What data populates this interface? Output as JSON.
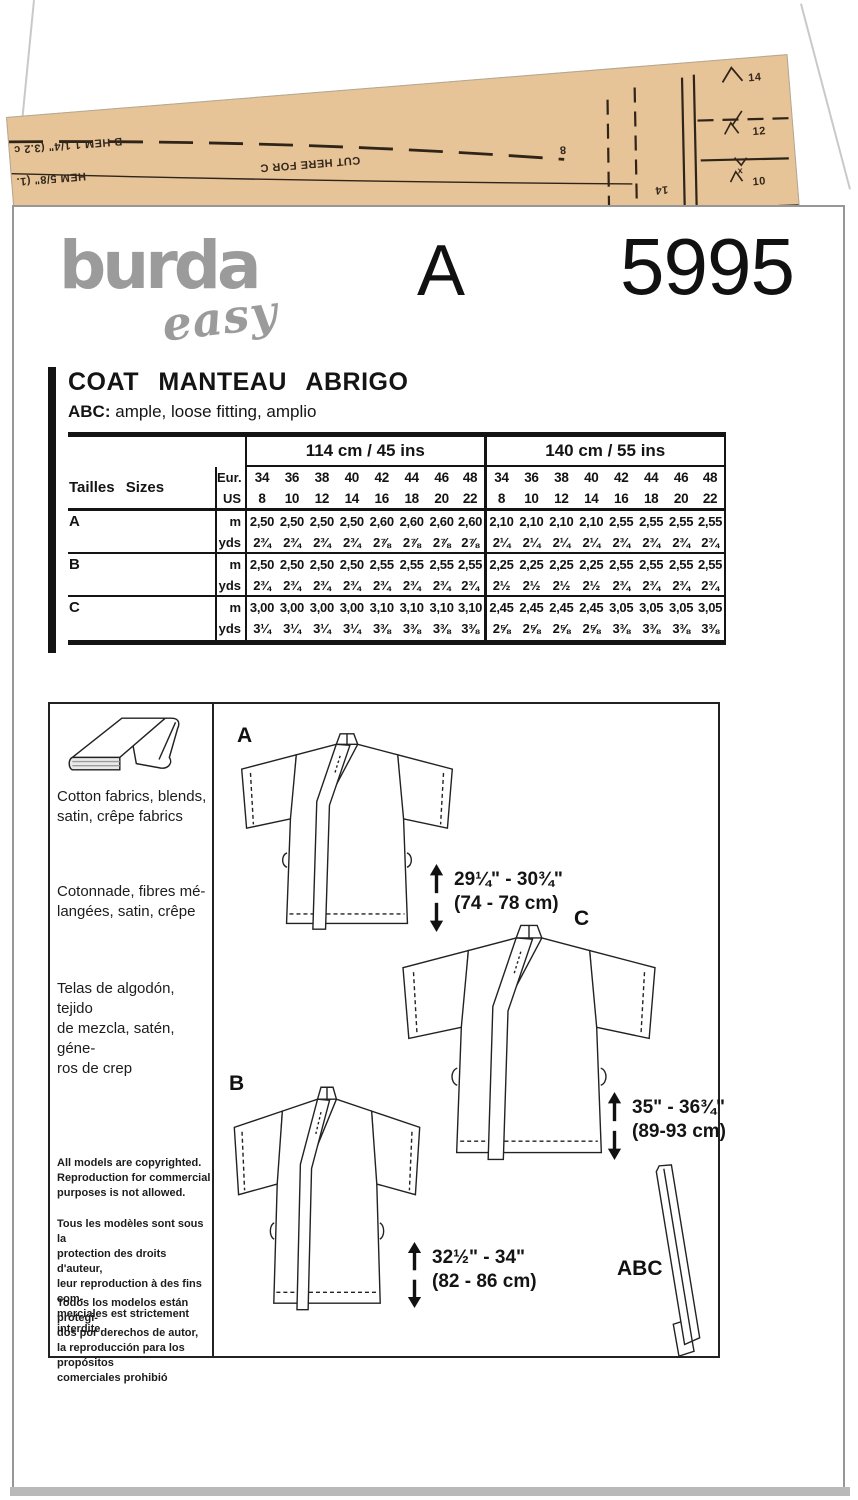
{
  "brand": {
    "logo_main": "burda",
    "logo_sub": "easy"
  },
  "header": {
    "view_letter": "A",
    "pattern_number": "5995"
  },
  "title": {
    "garment": "COAT MANTEAU ABRIGO",
    "fit_label": "ABC:",
    "fit_text": "ample, loose fitting, amplio"
  },
  "sizing_table": {
    "width_headers": [
      "114 cm / 45 ins",
      "140 cm / 55 ins"
    ],
    "size_label": "Tailles Sizes Tallas",
    "unit_rows": [
      "Eur.",
      "US"
    ],
    "sizes_eur": [
      "34",
      "36",
      "38",
      "40",
      "42",
      "44",
      "46",
      "48",
      "34",
      "36",
      "38",
      "40",
      "42",
      "44",
      "46",
      "48"
    ],
    "sizes_us": [
      "8",
      "10",
      "12",
      "14",
      "16",
      "18",
      "20",
      "22",
      "8",
      "10",
      "12",
      "14",
      "16",
      "18",
      "20",
      "22"
    ],
    "rows": [
      {
        "view": "A",
        "units": [
          "m",
          "yds"
        ],
        "m": [
          "2,50",
          "2,50",
          "2,50",
          "2,50",
          "2,60",
          "2,60",
          "2,60",
          "2,60",
          "2,10",
          "2,10",
          "2,10",
          "2,10",
          "2,55",
          "2,55",
          "2,55",
          "2,55"
        ],
        "yds": [
          "2¾",
          "2¾",
          "2¾",
          "2¾",
          "2⅞",
          "2⅞",
          "2⅞",
          "2⅞",
          "2¼",
          "2¼",
          "2¼",
          "2¼",
          "2¾",
          "2¾",
          "2¾",
          "2¾"
        ]
      },
      {
        "view": "B",
        "units": [
          "m",
          "yds"
        ],
        "m": [
          "2,50",
          "2,50",
          "2,50",
          "2,50",
          "2,55",
          "2,55",
          "2,55",
          "2,55",
          "2,25",
          "2,25",
          "2,25",
          "2,25",
          "2,55",
          "2,55",
          "2,55",
          "2,55"
        ],
        "yds": [
          "2¾",
          "2¾",
          "2¾",
          "2¾",
          "2¾",
          "2¾",
          "2¾",
          "2¾",
          "2½",
          "2½",
          "2½",
          "2½",
          "2¾",
          "2¾",
          "2¾",
          "2¾"
        ]
      },
      {
        "view": "C",
        "units": [
          "m",
          "yds"
        ],
        "m": [
          "3,00",
          "3,00",
          "3,00",
          "3,00",
          "3,10",
          "3,10",
          "3,10",
          "3,10",
          "2,45",
          "2,45",
          "2,45",
          "2,45",
          "3,05",
          "3,05",
          "3,05",
          "3,05"
        ],
        "yds": [
          "3¼",
          "3¼",
          "3¼",
          "3¼",
          "3⅜",
          "3⅜",
          "3⅜",
          "3⅜",
          "2⅝",
          "2⅝",
          "2⅝",
          "2⅝",
          "3⅜",
          "3⅜",
          "3⅜",
          "3⅜"
        ]
      }
    ]
  },
  "fabrics": {
    "en": "Cotton fabrics, blends,\nsatin, crêpe fabrics",
    "fr": "Cotonnade, fibres mé-\nlangées, satin, crêpe",
    "es": "Telas de algodón, tejido\nde mezcla, satén, géne-\nros de crep"
  },
  "copyright": {
    "en": "All models are copyrighted.\nReproduction for commercial\npurposes is not allowed.",
    "fr": "Tous les modèles sont sous la\nprotection des droits d'auteur,\nleur reproduction à des fins com-\nmerciales est strictement interdite.",
    "es": "Todos los modelos están protegi-\ndos por derechos de autor,\nla reproducción para los propósitos\ncomerciales prohibió"
  },
  "diagrams": {
    "views": [
      {
        "label": "A",
        "length_in": "29¼\" - 30¾\"",
        "length_cm": "(74 - 78 cm)"
      },
      {
        "label": "B",
        "length_in": "32½\" - 34\"",
        "length_cm": "(82 - 86 cm)"
      },
      {
        "label": "C",
        "length_in": "35\" - 36¾\"",
        "length_cm": "(89-93 cm)"
      }
    ],
    "belt_label": "ABC"
  },
  "tissue": {
    "hem_b": "B HEM 1 1/4\" (3.2 c",
    "hem_c": "HEM 5/8\" (1.",
    "cut_here": "CUT HERE FOR C",
    "size_8": "8",
    "size_14_rotated": "14",
    "notch_14": "14",
    "notch_12": "12",
    "notch_10": "10",
    "x_mark": "x"
  },
  "colors": {
    "tissue": "#e7c398",
    "logo_gray": "#9b9b9b",
    "ink": "#141414"
  }
}
